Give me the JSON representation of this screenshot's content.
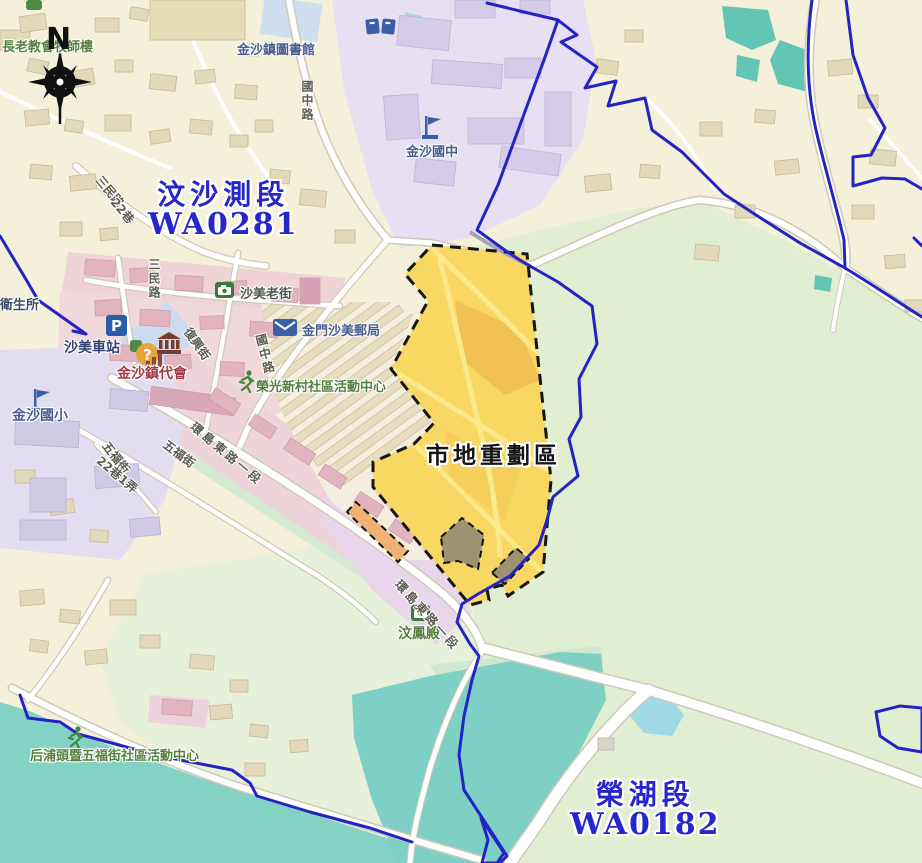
{
  "compass": {
    "label": "N"
  },
  "sections": [
    {
      "id": "wensha",
      "name": "汶沙測段",
      "code": "WA0281"
    },
    {
      "id": "ronghu",
      "name": "榮湖段",
      "code": "WA0182"
    }
  ],
  "zone": {
    "label": "市地重劃區"
  },
  "pois": [
    {
      "id": "presbyterian-manse",
      "text": "長老教會牧師樓"
    },
    {
      "id": "town-library",
      "text": "金沙鎮圖書館"
    },
    {
      "id": "junior-high-school",
      "text": "金沙國中"
    },
    {
      "id": "shamei-old-street",
      "text": "沙美老街"
    },
    {
      "id": "shamei-post-office",
      "text": "金門沙美郵局"
    },
    {
      "id": "shamei-bus-station",
      "text": "沙美車站"
    },
    {
      "id": "town-council",
      "text": "金沙鎮代會"
    },
    {
      "id": "rongguang-community-ctr",
      "text": "榮光新村社區活動中心"
    },
    {
      "id": "elementary-school",
      "text": "金沙國小"
    },
    {
      "id": "health-station",
      "text": "衛生所"
    },
    {
      "id": "wenfeng-temple",
      "text": "汶鳳殿"
    },
    {
      "id": "houputou-community-ctr",
      "text": "后浦頭暨五福街社區活動中心"
    }
  ],
  "roads": [
    {
      "id": "sanmin-rd-a",
      "text": "三民路"
    },
    {
      "id": "lane-22",
      "text": "22巷"
    },
    {
      "id": "sanmin-rd-b",
      "text": "三民路"
    },
    {
      "id": "guozhong-rd-n",
      "text": "國中路"
    },
    {
      "id": "guozhong-rd-s",
      "text": "國中路"
    },
    {
      "id": "fuxing-st",
      "text": "復興街"
    },
    {
      "id": "huandao-e-rd-1",
      "text": "環島東路一段"
    },
    {
      "id": "huandao-e-rd-2",
      "text": "環島東路一段"
    },
    {
      "id": "wufu-st-1",
      "text": "五福街"
    },
    {
      "id": "wufu-st-2",
      "text": "五福街"
    },
    {
      "id": "lane22-alley1",
      "text": "22巷1弄"
    }
  ],
  "icons": {
    "parking_letter": "P",
    "info_mark": "?"
  },
  "colors": {
    "section_label_blue": "#2626cd",
    "boundary_blue": "#2424c4",
    "zone_fill_yellow": "#f8d763",
    "zone_outline_black": "#151515",
    "water_teal": "#84d2c4",
    "campus_lavender": "#e7e0f2",
    "residential_pink": "#f0d6d9",
    "base_cream": "#f4f0da",
    "open_green": "#e2eed2"
  }
}
